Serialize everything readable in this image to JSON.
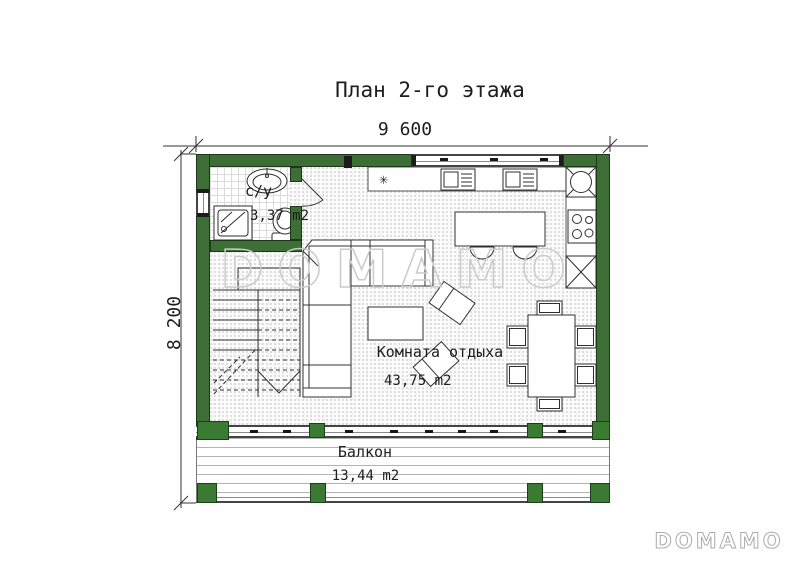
{
  "title": "План 2-го этажа",
  "dimensions": {
    "width": "9 600",
    "height": "8 200"
  },
  "rooms": {
    "bathroom": {
      "name": "с/у",
      "area": "3,37 m2"
    },
    "lounge": {
      "name": "Комната отдыха",
      "area": "43,75 m2"
    },
    "balcony": {
      "name": "Балкон",
      "area": "13,44 m2"
    }
  },
  "symbols": {
    "kitchen_star": "✳"
  },
  "watermark": {
    "text": "DOMAMO"
  },
  "logo": {
    "text": "DOMAMO"
  },
  "colors": {
    "wall_green": "#3d6e36",
    "post_green": "#3a7a33",
    "line_dark": "#2b2b2b",
    "watermark_gray": "#cbcbcb"
  }
}
